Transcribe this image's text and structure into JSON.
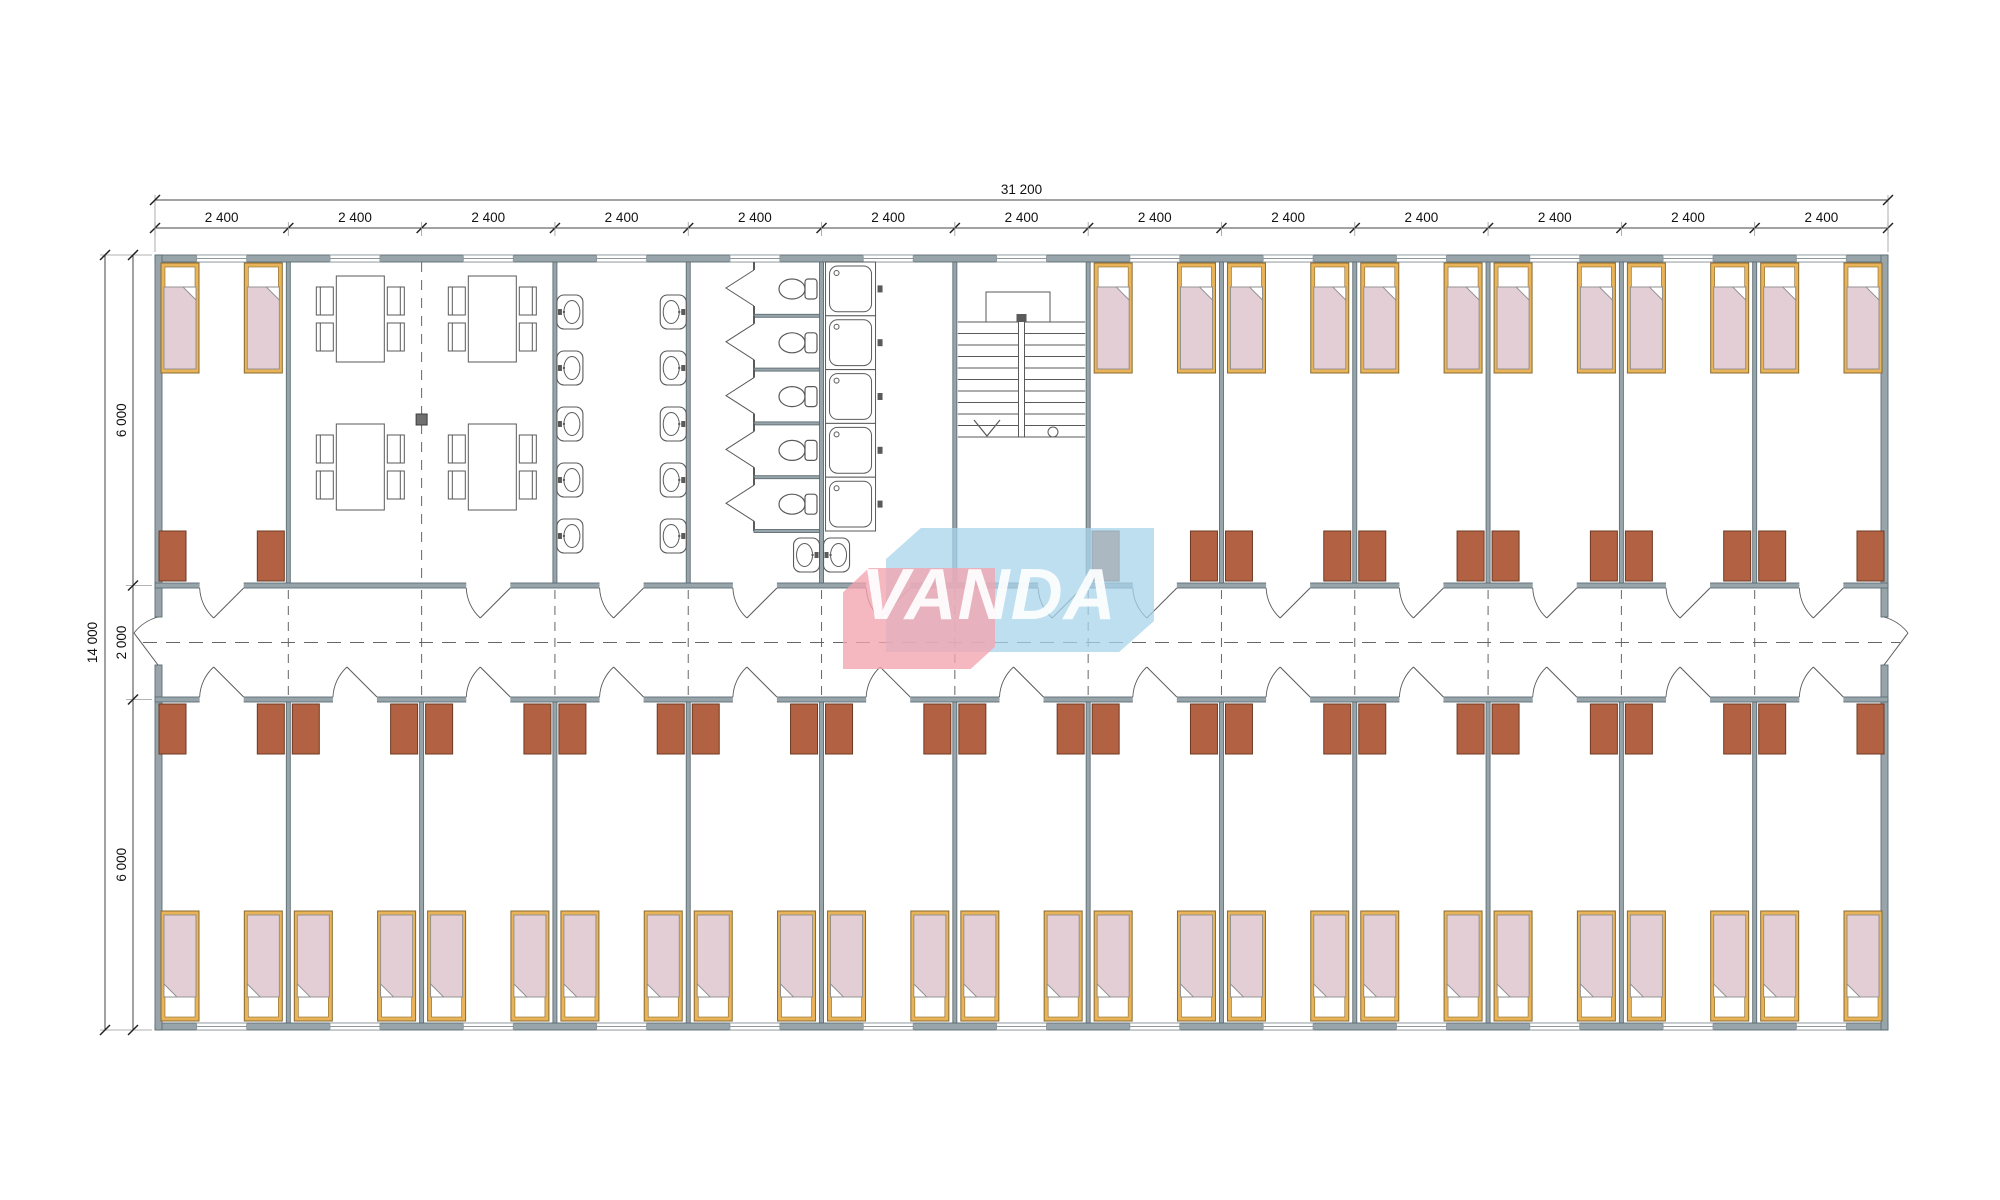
{
  "logo": {
    "text": "VANDA",
    "blue": "rgba(168,212,235,0.75)",
    "pink": "rgba(242,164,176,0.78)",
    "text_color": "#ffffff"
  },
  "dimensions": {
    "total_width_label": "31 200",
    "bay_label": "2 400",
    "bay_count": 13,
    "total_height_label": "14 000",
    "height_segment_labels": [
      "6 000",
      "2 000",
      "6 000"
    ]
  },
  "plan": {
    "top_row": [
      "bedroom",
      "dining",
      "dining",
      "washroom",
      "toilets",
      "showers",
      "stairs",
      "bedroom",
      "bedroom",
      "bedroom",
      "bedroom",
      "bedroom",
      "bedroom"
    ],
    "bottom_row": [
      "bedroom",
      "bedroom",
      "bedroom",
      "bedroom",
      "bedroom",
      "bedroom",
      "bedroom",
      "bedroom",
      "bedroom",
      "bedroom",
      "bedroom",
      "bedroom",
      "bedroom"
    ],
    "room": {
      "beds": 2,
      "wardrobes": 2
    },
    "counts": {
      "wash_basin_rows": 5,
      "wash_basin_columns": 2,
      "corner_basins": 2,
      "toilet_stalls": 5,
      "showers": 5,
      "dining_table_rows": 2,
      "dining_table_columns": 2,
      "chairs_per_table": 4,
      "stair_treads": 11
    }
  },
  "colors": {
    "wall_fill": "#97a5ab",
    "wall_stroke": "#5e6d74",
    "partition_fill": "#8b9aa0",
    "fixture_stroke": "#5a5a5a",
    "bed_frame": "#e9b458",
    "bed_frame_stroke": "#8a6a30",
    "blanket": "#e3ced5",
    "blanket_stroke": "#8d8d8d",
    "pillow": "#ffffff",
    "wardrobe": "#b26243",
    "wardrobe_stroke": "#6e3a22",
    "dash_line": "#666666",
    "dim_line": "#444444",
    "dim_text": "#111111",
    "window_line": "#8d979c",
    "axis_square": "#6f6f6f"
  }
}
